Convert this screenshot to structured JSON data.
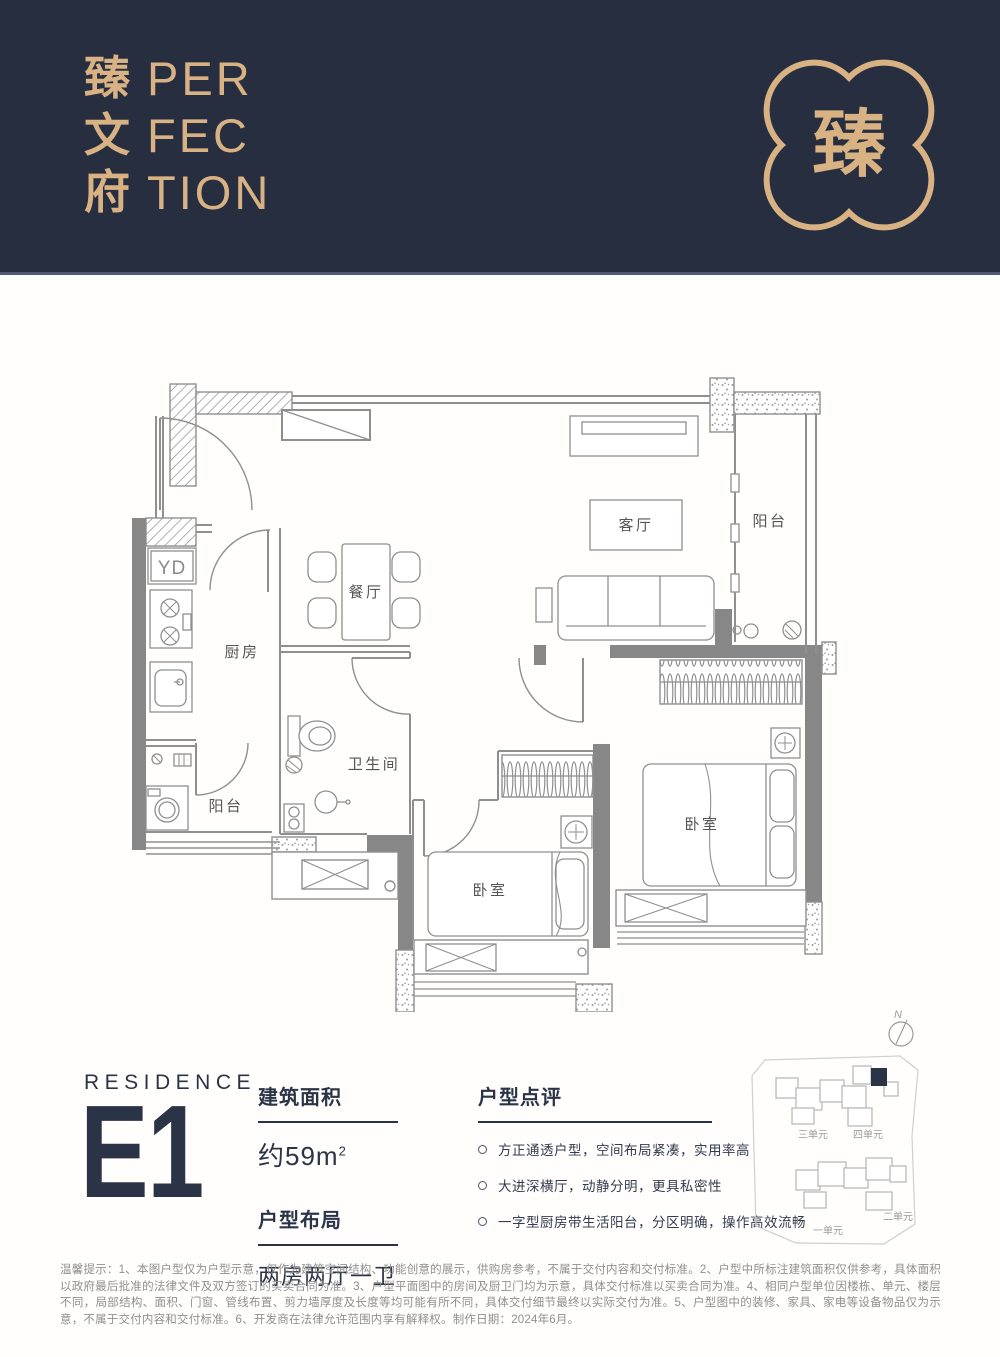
{
  "colors": {
    "navy": "#262e40",
    "gold": "#d9b284",
    "text_navy": "#2b3447",
    "line_gray": "#8f8f8f"
  },
  "header": {
    "brand_chars": [
      "臻",
      "文",
      "府"
    ],
    "brand_latin": [
      "PER",
      "FEC",
      "TION"
    ],
    "logo_glyph": "臻"
  },
  "floorplan": {
    "living_room": "客厅",
    "balcony_right": "阳台",
    "dining_room": "餐厅",
    "kitchen": "厨房",
    "bathroom": "卫生间",
    "balcony_left": "阳台",
    "bedroom_1": "卧室",
    "bedroom_2": "卧室",
    "duct": "YD"
  },
  "info": {
    "residence_label": "RESIDENCE",
    "unit_code": "E1",
    "area": {
      "title": "建筑面积",
      "value": "约59m",
      "sup": "2"
    },
    "layout": {
      "title": "户型布局",
      "value": "两房两厅一卫"
    },
    "review": {
      "title": "户型点评",
      "points": [
        "方正通透户型，空间布局紧凑，实用率高",
        "大进深横厅，动静分明，更具私密性",
        "一字型厨房带生活阳台，分区明确，操作高效流畅"
      ]
    }
  },
  "sitemap": {
    "north": "N",
    "unit_1": "一单元",
    "unit_2": "二单元",
    "unit_3": "三单元",
    "unit_4": "四单元"
  },
  "disclaimer": "温馨提示：1、本图户型仅为户型示意，仅作为建筑空间结构、功能创意的展示，供购房参考，不属于交付内容和交付标准。2、户型中所标注建筑面积仅供参考，具体面积以政府最后批准的法律文件及双方签订的买卖合同为准。3、户型平面图中的房间及厨卫门均为示意，具体交付标准以买卖合同为准。4、相同户型单位因楼栋、单元、楼层不同，局部结构、面积、门窗、管线布置、剪力墙厚度及长度等均可能有所不同，具体交付细节最终以实际交付为准。5、户型图中的装修、家具、家电等设备物品仅为示意，不属于交付内容和交付标准。6、开发商在法律允许范围内享有解释权。制作日期：2024年6月。"
}
